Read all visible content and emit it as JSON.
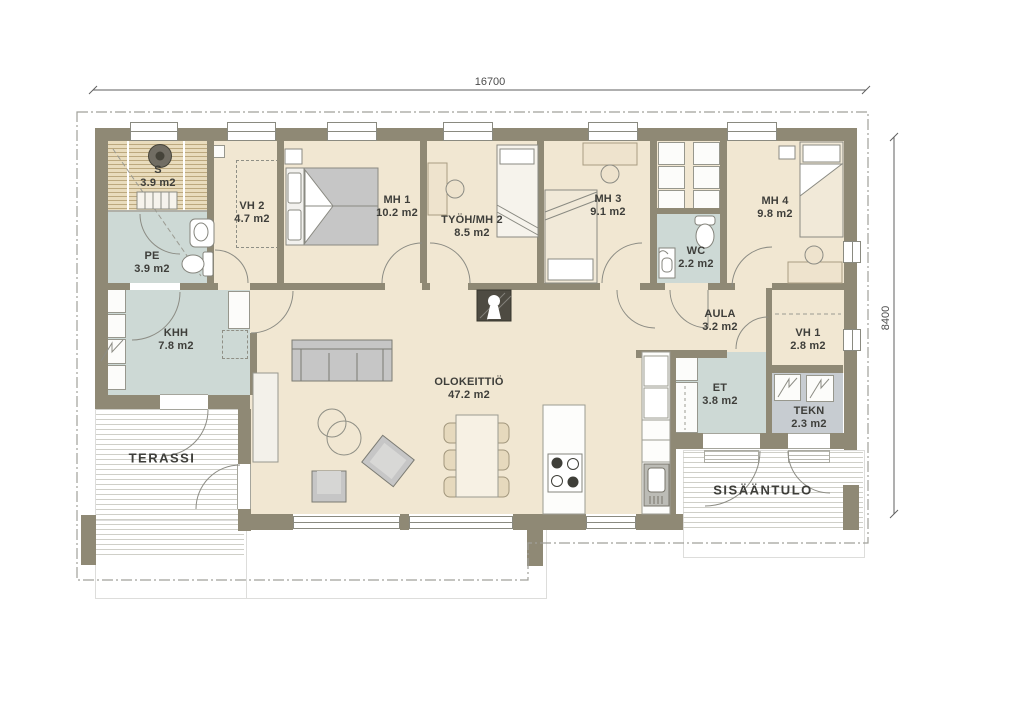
{
  "plan": {
    "dimension_top": "16700",
    "dimension_right": "8400"
  },
  "rooms": {
    "s": {
      "name": "S",
      "area": "3.9 m2"
    },
    "pe": {
      "name": "PE",
      "area": "3.9 m2"
    },
    "vh2": {
      "name": "VH 2",
      "area": "4.7 m2"
    },
    "mh1": {
      "name": "MH 1",
      "area": "10.2 m2"
    },
    "tyoh_mh2": {
      "name": "TYÖH/MH 2",
      "area": "8.5 m2"
    },
    "mh3": {
      "name": "MH 3",
      "area": "9.1 m2"
    },
    "wc": {
      "name": "WC",
      "area": "2.2 m2"
    },
    "mh4": {
      "name": "MH 4",
      "area": "9.8 m2"
    },
    "khh": {
      "name": "KHH",
      "area": "7.8 m2"
    },
    "aula": {
      "name": "AULA",
      "area": "3.2 m2"
    },
    "vh1": {
      "name": "VH 1",
      "area": "2.8 m2"
    },
    "olokeittio": {
      "name": "OLOKEITTIÖ",
      "area": "47.2 m2"
    },
    "et": {
      "name": "ET",
      "area": "3.8 m2"
    },
    "tekn": {
      "name": "TEKN",
      "area": "2.3 m2"
    }
  },
  "outdoor": {
    "terassi": "TERASSI",
    "sisaantulo": "SISÄÄNTULO"
  },
  "palette": {
    "wall": "#8f8975",
    "floor": "#f1e7d2",
    "wet_floor": "#cdd9d5",
    "tech_floor": "#c7ccd1",
    "sauna_wood": "#e9dcbd",
    "furniture_grey": "#c6c6c6",
    "furniture_beige": "#eee3cd"
  }
}
